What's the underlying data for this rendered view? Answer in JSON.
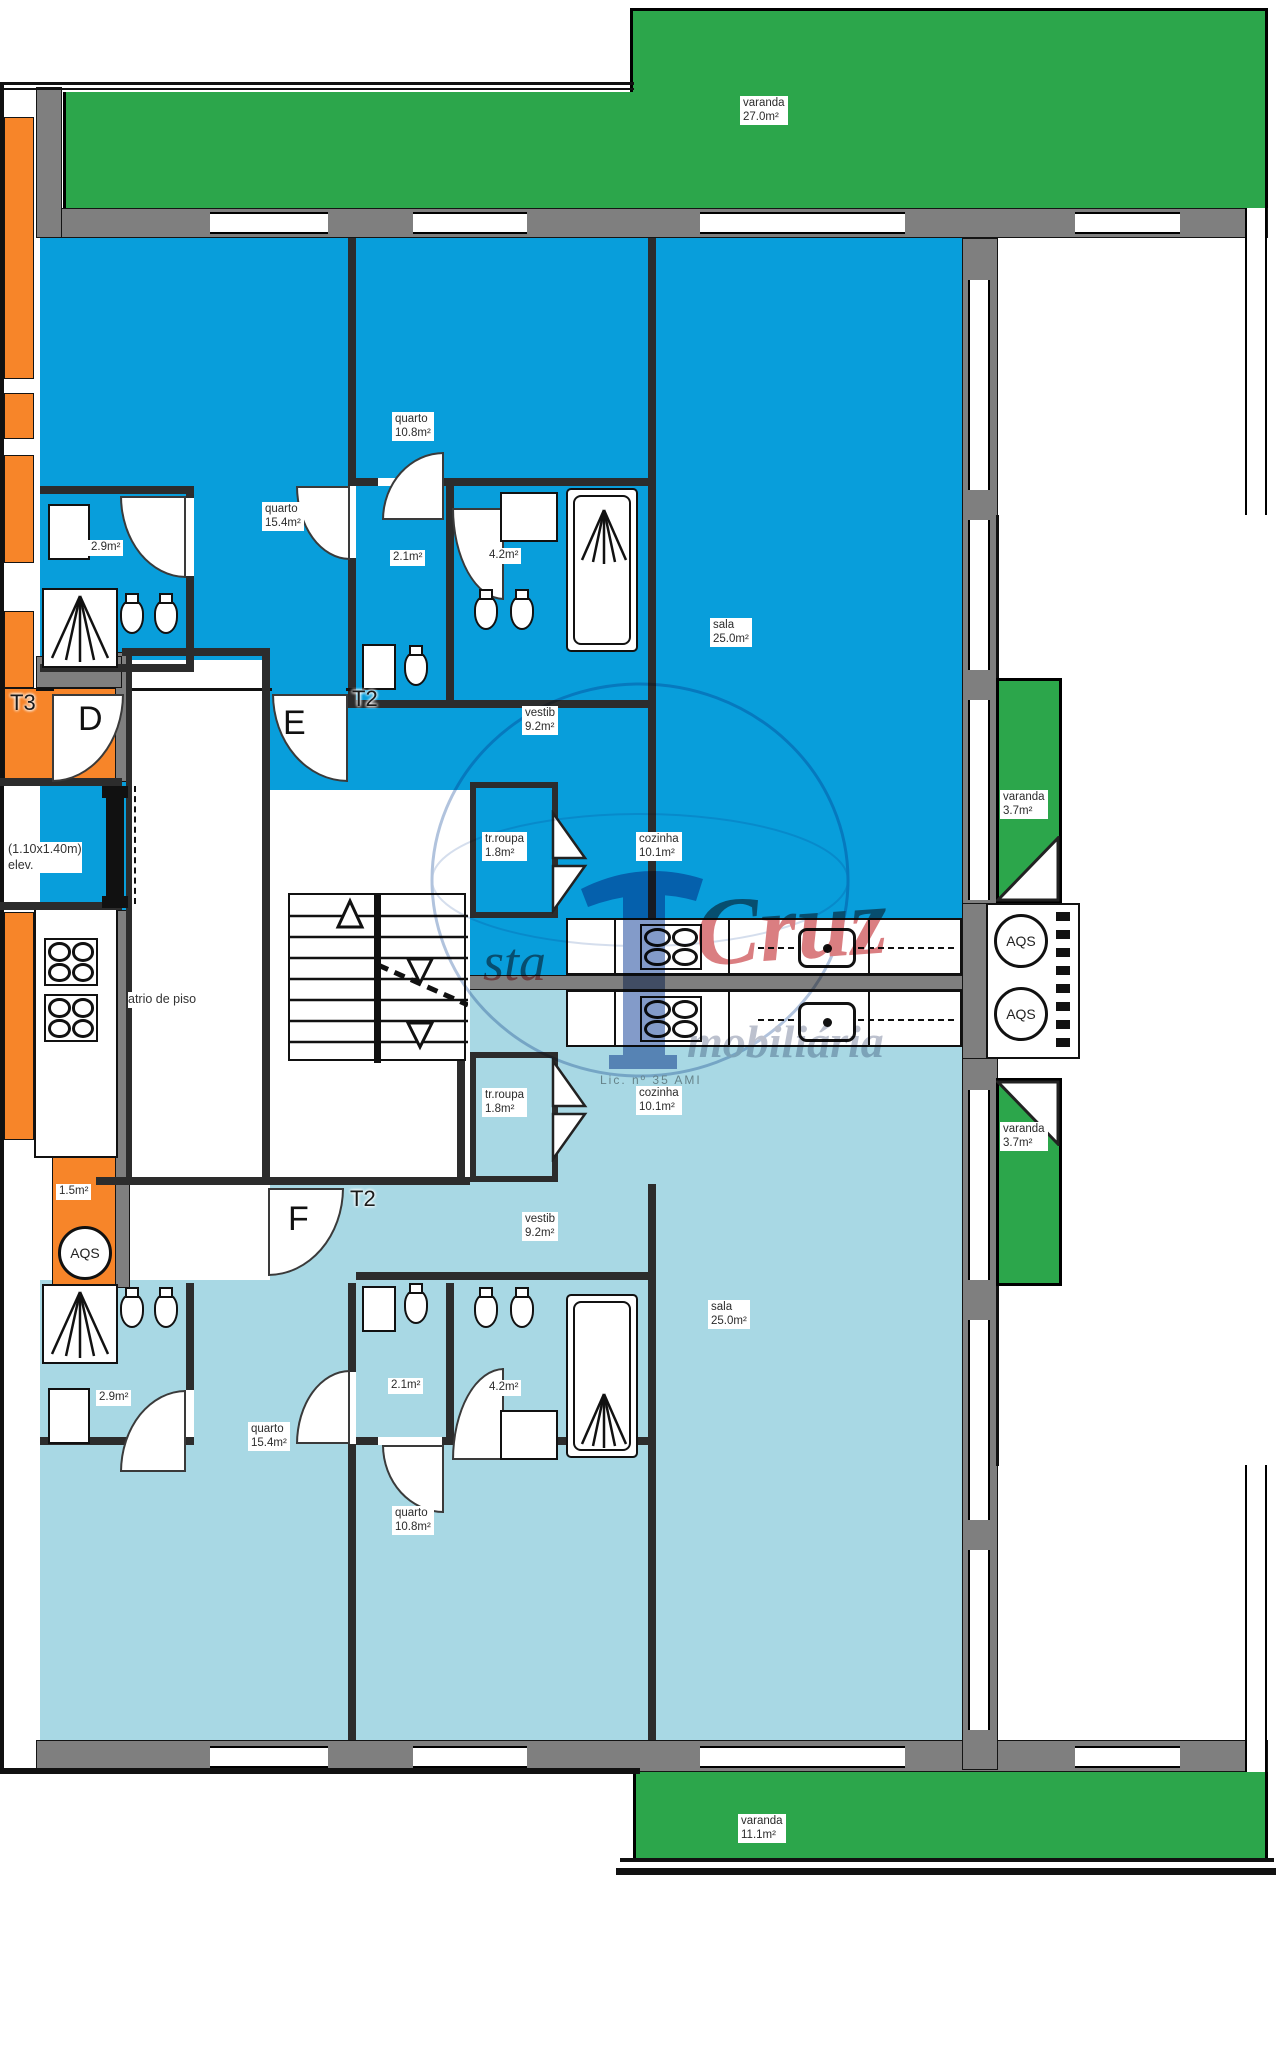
{
  "watermark": {
    "prefix": "sta",
    "brand": "Cruz",
    "suffix": "mobiliária",
    "license": "Lic. nº 35 AMI"
  },
  "units": {
    "t3": {
      "type": "T3",
      "door": "D"
    },
    "upper": {
      "type": "T2",
      "door": "E"
    },
    "lower": {
      "type": "T2",
      "door": "F"
    }
  },
  "core": {
    "atrium": "atrio de piso",
    "elevator_dims": "(1.10x1.40m)",
    "elevator": "elev.",
    "aqs": "AQS",
    "t3_wc": "1.5m²"
  },
  "upper_apartment": {
    "balcony_top": {
      "name": "varanda",
      "area": "27.0m²"
    },
    "bedroom_large": {
      "name": "quarto",
      "area": "15.4m²"
    },
    "bedroom_small": {
      "name": "quarto",
      "area": "10.8m²"
    },
    "bath_a": {
      "area": "2.9m²"
    },
    "bath_b": {
      "area": "2.1m²"
    },
    "bath_c": {
      "area": "4.2m²"
    },
    "living": {
      "name": "sala",
      "area": "25.0m²"
    },
    "hall": {
      "name": "vestib",
      "area": "9.2m²"
    },
    "laundry": {
      "name": "tr.roupa",
      "area": "1.8m²"
    },
    "kitchen": {
      "name": "cozinha",
      "area": "10.1m²"
    },
    "balcony_side": {
      "name": "varanda",
      "area": "3.7m²"
    }
  },
  "lower_apartment": {
    "bedroom_large": {
      "name": "quarto",
      "area": "15.4m²"
    },
    "bedroom_small": {
      "name": "quarto",
      "area": "10.8m²"
    },
    "bath_a": {
      "area": "2.9m²"
    },
    "bath_b": {
      "area": "2.1m²"
    },
    "bath_c": {
      "area": "4.2m²"
    },
    "living": {
      "name": "sala",
      "area": "25.0m²"
    },
    "hall": {
      "name": "vestib",
      "area": "9.2m²"
    },
    "laundry": {
      "name": "tr.roupa",
      "area": "1.8m²"
    },
    "kitchen": {
      "name": "cozinha",
      "area": "10.1m²"
    },
    "balcony_side": {
      "name": "varanda",
      "area": "3.7m²"
    },
    "balcony_bottom": {
      "name": "varanda",
      "area": "11.1m²"
    }
  }
}
